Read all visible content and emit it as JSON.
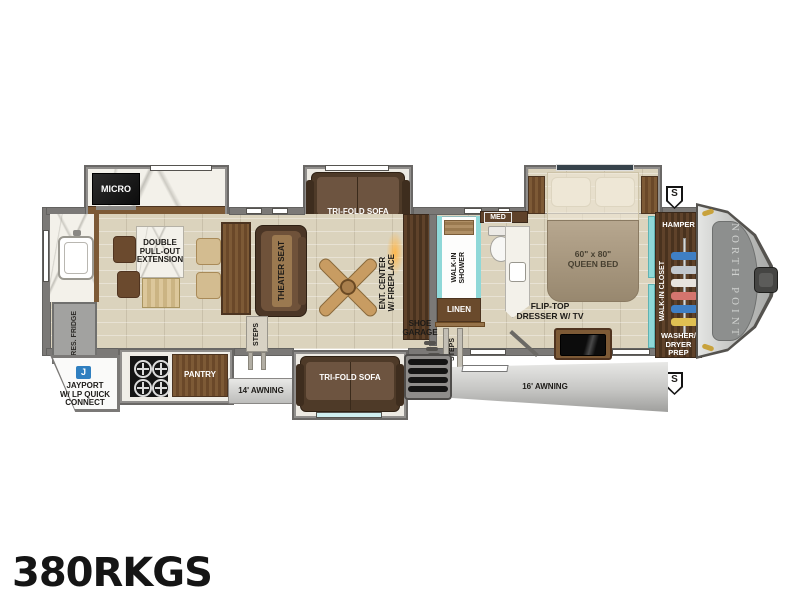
{
  "plan": {
    "model": "380RKGS",
    "front_cap_brand": "NORTH POINT",
    "exterior": {
      "awning_left": "14' AWNING",
      "awning_right": "16' AWNING",
      "jayport_icon": "J",
      "jayport": "JAYPORT\nW/ LP QUICK\nCONNECT",
      "solar_marker": "S"
    },
    "kitchen": {
      "micro": "MICRO",
      "dinette": "DOUBLE\nPULL-OUT\nEXTENSION",
      "fridge": "RES. FRIDGE",
      "pantry": "PANTRY"
    },
    "living": {
      "sofa_top": "TRI-FOLD SOFA",
      "sofa_bottom": "TRI-FOLD SOFA",
      "theater": "THEATER SEAT",
      "ent_center": "ENT. CENTER\nW/ FIREPLACE",
      "steps": "STEPS",
      "shoe_garage": "SHOE\nGARAGE"
    },
    "bath": {
      "shower": "WALK-IN\nSHOWER",
      "med": "MED",
      "linen": "LINEN",
      "steps": "STEPS"
    },
    "bedroom": {
      "bed": "60\" x 80\"\nQUEEN BED",
      "dresser": "FLIP-TOP\nDRESSER W/ TV"
    },
    "front": {
      "hamper": "HAMPER",
      "closet": "WALK-IN CLOSET",
      "washer_dryer": "WASHER/\nDRYER\nPREP"
    },
    "colors": {
      "teal_accent": "#8fd8d8",
      "jayport_blue": "#2f7fc0",
      "fireplace_orange": "#f5a935",
      "clearance_light_gold": "#c8a23c"
    }
  }
}
